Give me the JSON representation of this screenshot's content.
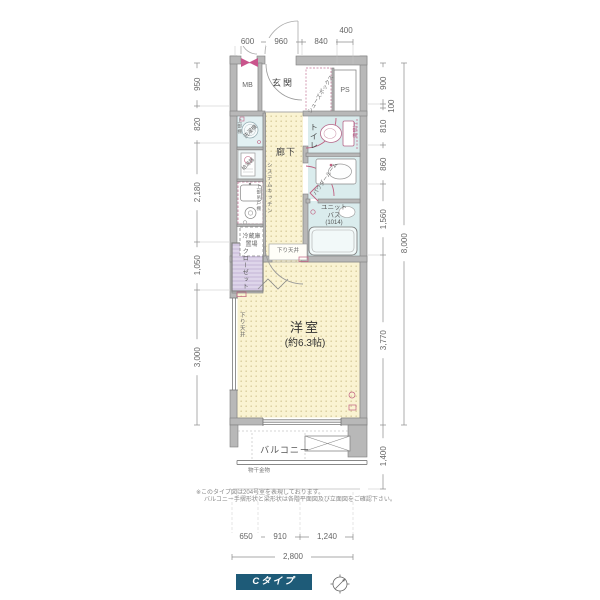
{
  "colors": {
    "accent_pink": "#c9548c",
    "wall_gray": "#b8b8b8",
    "wet_area_blue": "#daeced",
    "floor_cream": "#faf3d2",
    "closet_lavender": "#ded5ea",
    "type_box_blue": "#1e5b78"
  },
  "dimensions": {
    "top": [
      "600",
      "960",
      "840",
      "400"
    ],
    "left": [
      "950",
      "820",
      "2,180",
      "1,050",
      "3,000"
    ],
    "right": [
      "900",
      "100",
      "810",
      "860",
      "1,560",
      "3,770"
    ],
    "right_total": "8,000",
    "balcony_depth": "1,400",
    "bottom": [
      "650",
      "910",
      "1,240"
    ],
    "bottom_total": "2,800"
  },
  "rooms": {
    "meter_box": "MB",
    "entrance": "玄関",
    "shoe_box": "シューズボックス",
    "pipe_space": "PS",
    "toilet": "トイレ",
    "toilet_upper_shelf": "上部棚",
    "washer_upper_shelf": "上部棚",
    "washer": "洗濯機",
    "water_heater": "給湯器",
    "upper_cabinet": "上部吊戸棚",
    "system_kitchen": "システムキッチン",
    "fridge_line1": "冷蔵庫",
    "fridge_line2": "置場",
    "hallway": "廊下",
    "powder_room": "パウダールーム",
    "unit_bath_line1": "ユニット",
    "unit_bath_line2": "バス",
    "unit_bath_size": "(1014)",
    "closet": "クローゼット",
    "lowered_ceiling_top": "下り天井",
    "lowered_ceiling_side": "下り天井",
    "main_room": "洋室",
    "main_room_size": "(約6.3帖)",
    "balcony": "バルコニー",
    "drying_fixture": "物干金物"
  },
  "notes": {
    "line1": "※このタイプ図は204号室を表現しております。",
    "line2": "バルコニー手摺形状と梁形状は各階平面図及び立面図をご確認下さい。"
  },
  "legend": {
    "type_label": "Cタイプ"
  }
}
